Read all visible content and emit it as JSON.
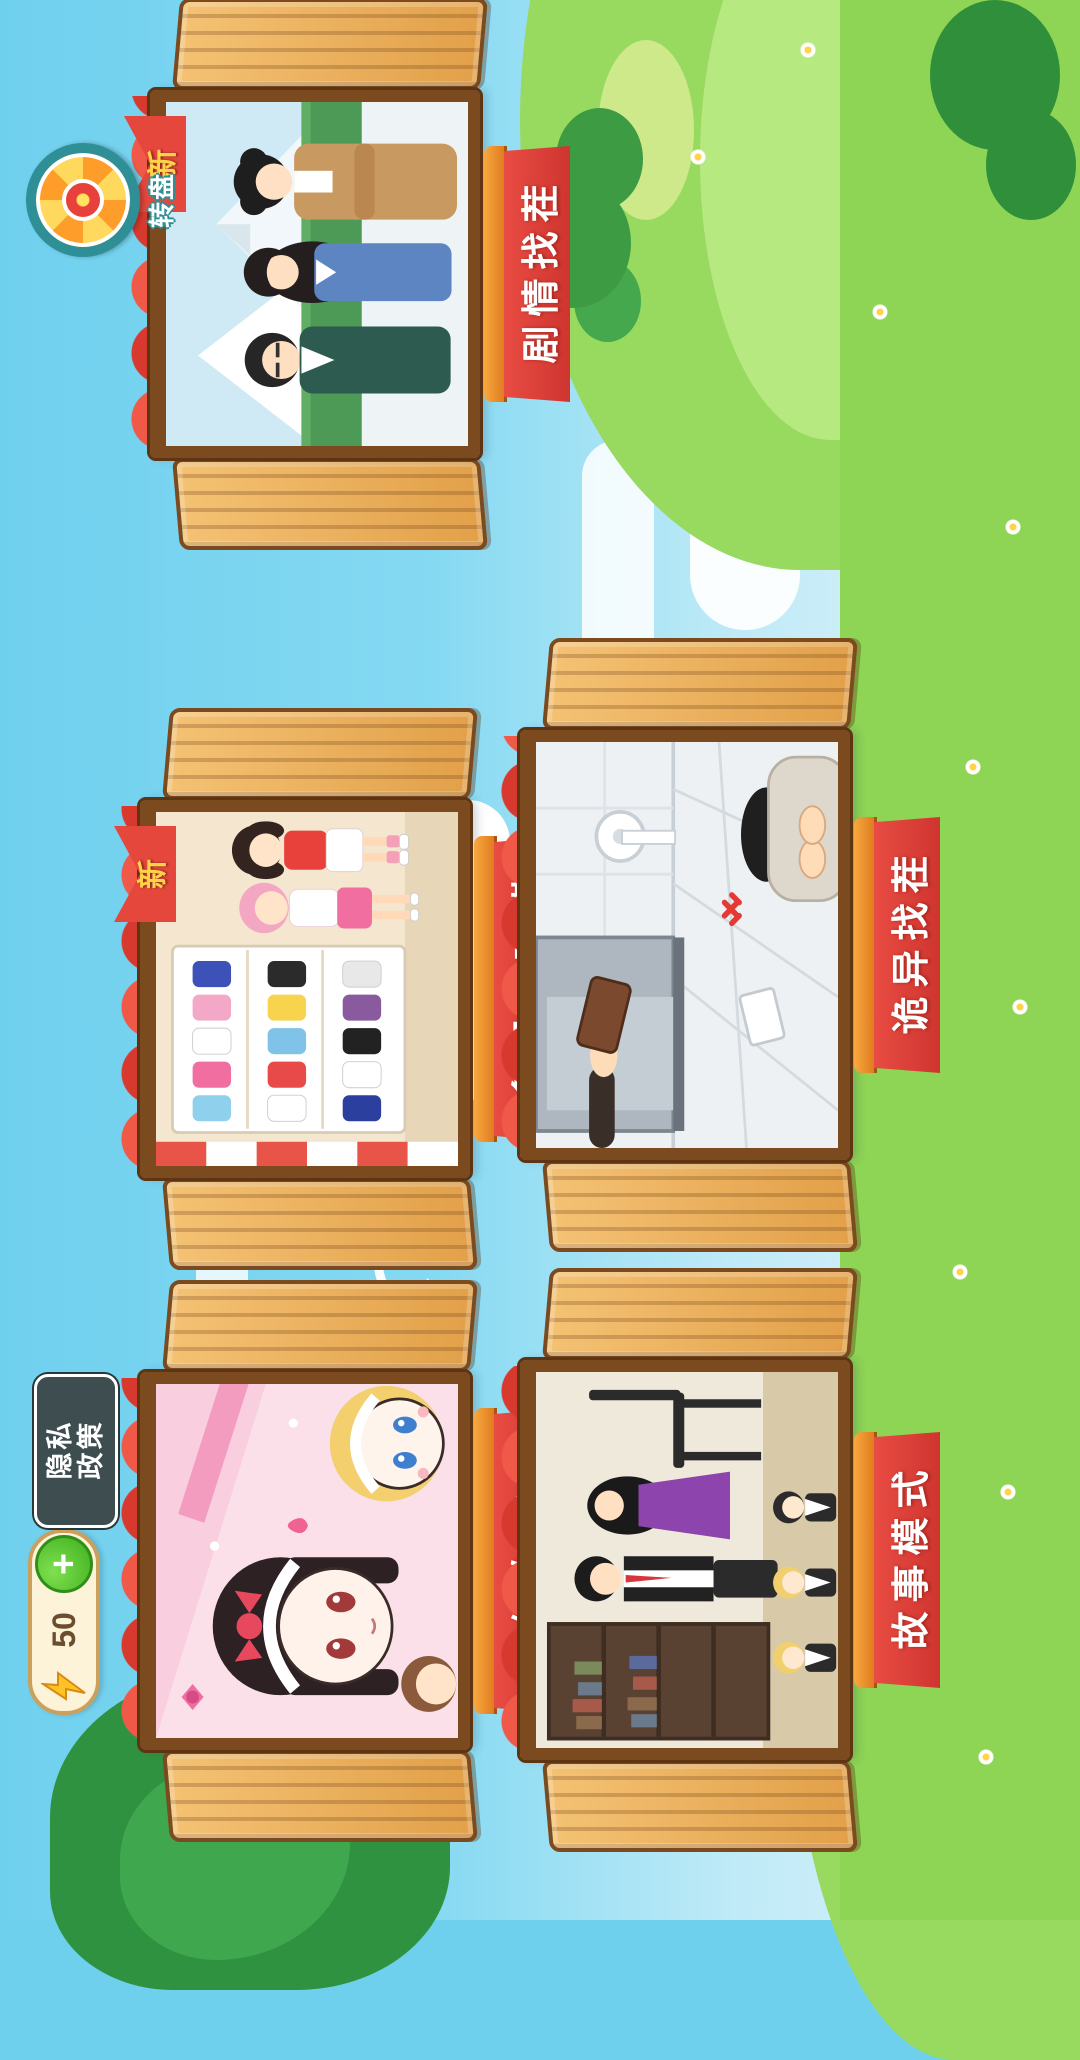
{
  "hud": {
    "energy": {
      "value": "50",
      "add_label": "+",
      "icon": "lightning-icon"
    },
    "privacy_button": {
      "line1": "隐私",
      "line2": "政策"
    },
    "wheel_button": {
      "label": "转盘",
      "icon": "prize-wheel-icon"
    }
  },
  "badge": {
    "new_label": "新"
  },
  "cards": [
    {
      "title": "贴纸女孩儿",
      "is_new": false,
      "art": "sticker-girls"
    },
    {
      "title": "多巴胺穿搭",
      "is_new": true,
      "art": "dopamine-dressup"
    },
    {
      "title": "剧情找茬",
      "is_new": true,
      "art": "story-spot-difference"
    },
    {
      "title": "故事模式",
      "is_new": false,
      "art": "story-mode-office"
    },
    {
      "title": "诡异找茬",
      "is_new": false,
      "art": "weird-spot-difference"
    }
  ],
  "colors": {
    "sky": "#6fd0ee",
    "grass": "#8ed455",
    "banner_red": "#e84c43",
    "banner_trim": "#f7a93f",
    "wood": "#e2a049",
    "frame_brown": "#7c4a1f",
    "badge_red": "#e5473c",
    "badge_text": "#ffd24a",
    "energy_bg": "#fcf3d8",
    "plus_green": "#3fae1f",
    "privacy_bg": "#3d4d50",
    "wheel_ring": "#2f8f96"
  }
}
